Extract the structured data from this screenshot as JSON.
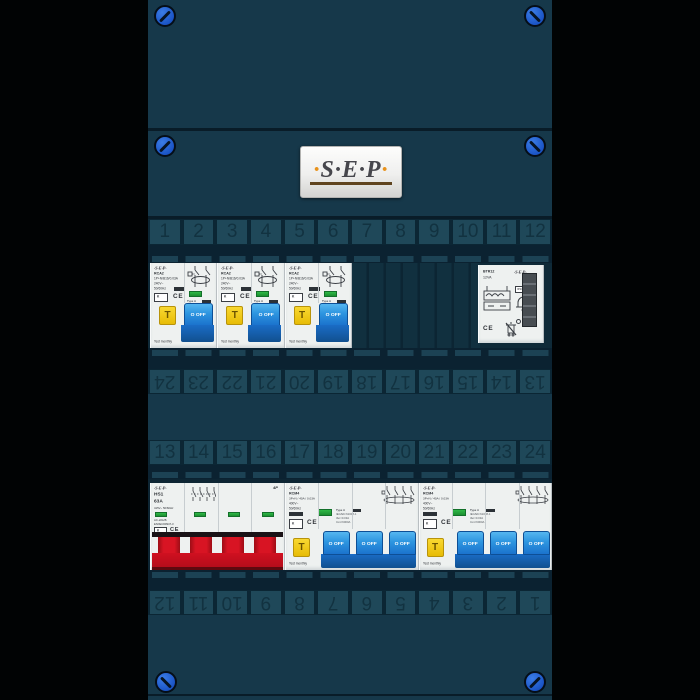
{
  "colors": {
    "panel_teal": "#16384a",
    "recess_dark": "#0b2231",
    "strip_cell": "#1f4859",
    "screw_blue": "#1b55c6",
    "device_white": "#eef1f0",
    "toggle_blue": "#2d95e0",
    "test_button_yellow": "#e7bc06",
    "indicator_green": "#23a339",
    "handle_red": "#d81423",
    "logo_orange": "#e8921c"
  },
  "brand_plate": {
    "text": "S·E·P"
  },
  "strips": {
    "top": [
      "1",
      "2",
      "3",
      "4",
      "5",
      "6",
      "7",
      "8",
      "9",
      "10",
      "11",
      "12"
    ],
    "upper_middle_rotated": [
      "13",
      "14",
      "15",
      "16",
      "17",
      "18",
      "19",
      "20",
      "21",
      "22",
      "23",
      "24"
    ],
    "lower_middle": [
      "13",
      "14",
      "15",
      "16",
      "17",
      "18",
      "19",
      "20",
      "21",
      "22",
      "23",
      "24"
    ],
    "bottom_rotated": [
      "1",
      "2",
      "3",
      "4",
      "5",
      "6",
      "7",
      "8",
      "9",
      "10",
      "11",
      "12"
    ]
  },
  "devices": {
    "rcbo": {
      "count": 3,
      "brand": "·S·E·P·",
      "model": "RCA2",
      "spec": "1P+N/B16/0.03A",
      "voltage": "240V~",
      "frequency": "50/60Hz",
      "approval": "K",
      "ce": "CE",
      "type_block": [
        "Type A",
        "IEC/EN 61009-1",
        "IΔn=0.03A",
        "Inm=6000A"
      ],
      "test_button": "T",
      "toggle": "O OFF",
      "note": "Test monthly"
    },
    "bell_transformer": {
      "brand": "·S·E·P·",
      "model": "BTR12",
      "rating": "12VA",
      "ip_rating": "IP20",
      "ce": "CE"
    },
    "main_switch": {
      "brand": "·S·E·P·",
      "model": "HS1",
      "current": "63A",
      "voltage": "415V~  50/60Hz",
      "utilization": "AC-22A/B",
      "standard": "EN/IEC60947-3",
      "poles": "4P",
      "approval": "K",
      "ce": "CE"
    },
    "rcd": {
      "count": 2,
      "brand": "·S·E·P·",
      "model": "RCM4",
      "spec": "3P+N / 40A / 0.03A",
      "voltage": "400V~",
      "frequency": "50/60Hz",
      "approval": "K",
      "ce": "CE",
      "type_block": [
        "Type A",
        "IEC/EN 61008-1",
        "IΔn=0.03A",
        "Inm=6000A"
      ],
      "test_button": "T",
      "toggle": "O OFF",
      "note": "Test monthly"
    }
  }
}
